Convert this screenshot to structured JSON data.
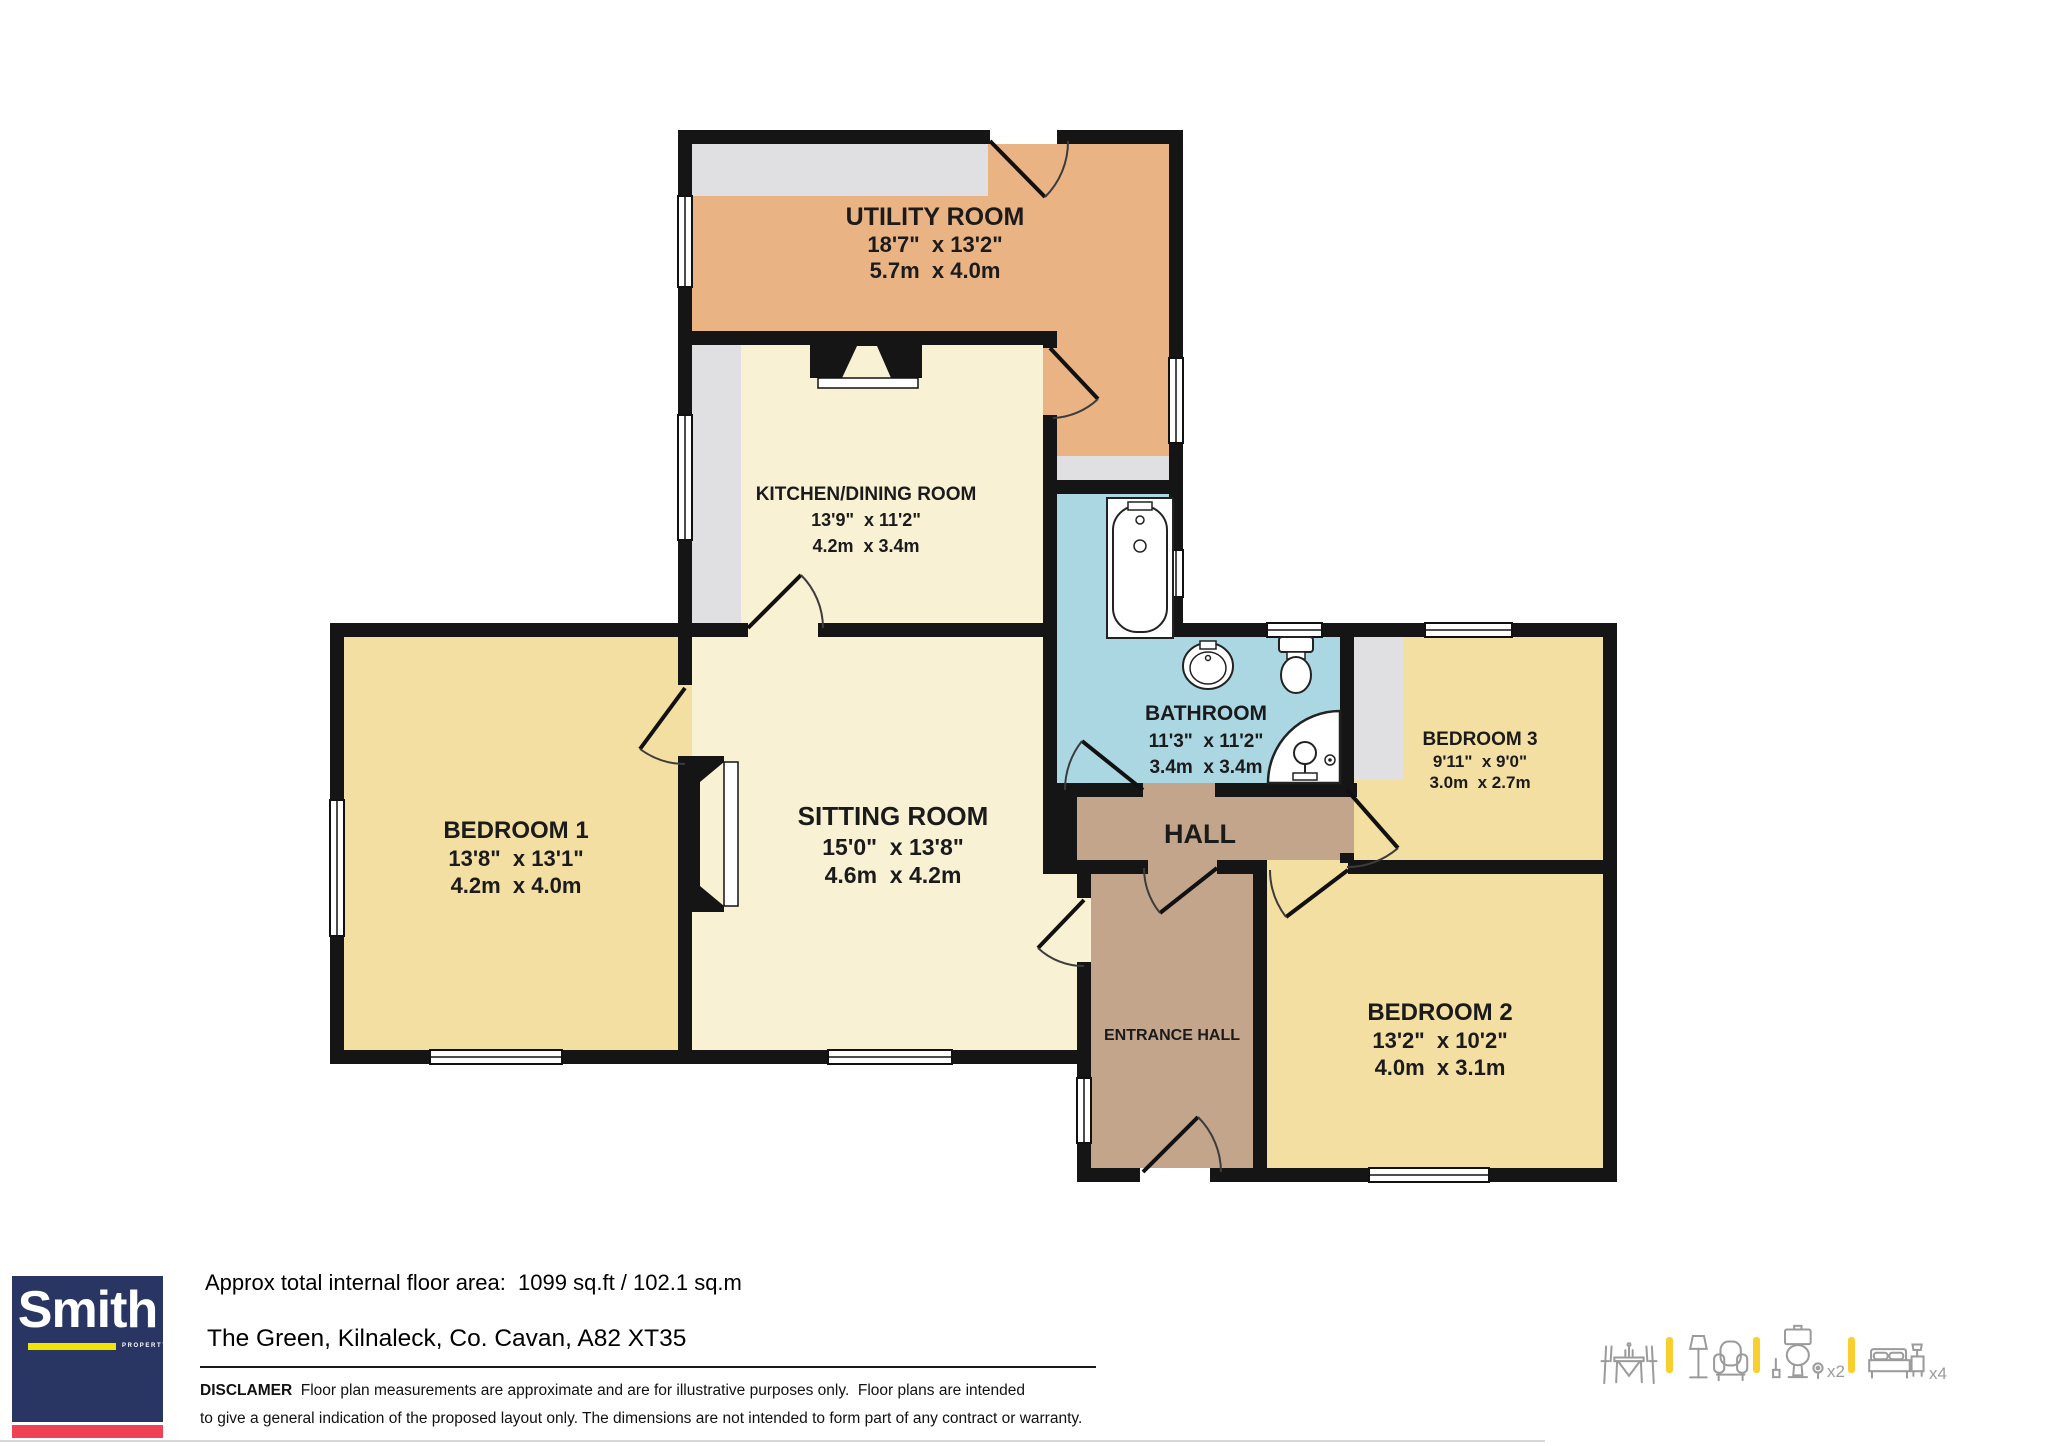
{
  "plan": {
    "rooms": [
      {
        "id": "utility",
        "name": "UTILITY ROOM",
        "imperial": "18'7\"  x 13'2\"",
        "metric": "5.7m  x 4.0m"
      },
      {
        "id": "kitchen",
        "name": "KITCHEN/DINING ROOM",
        "imperial": "13'9\"  x 11'2\"",
        "metric": "4.2m  x 3.4m"
      },
      {
        "id": "bathroom",
        "name": "BATHROOM",
        "imperial": "11'3\"  x 11'2\"",
        "metric": "3.4m  x 3.4m"
      },
      {
        "id": "bedroom1",
        "name": "BEDROOM 1",
        "imperial": "13'8\"  x 13'1\"",
        "metric": "4.2m  x 4.0m"
      },
      {
        "id": "sitting",
        "name": "SITTING ROOM",
        "imperial": "15'0\"  x 13'8\"",
        "metric": "4.6m  x 4.2m"
      },
      {
        "id": "bedroom3",
        "name": "BEDROOM 3",
        "imperial": "9'11\"  x 9'0\"",
        "metric": "3.0m  x 2.7m"
      },
      {
        "id": "hall",
        "name": "HALL"
      },
      {
        "id": "entrance",
        "name": "ENTRANCE HALL"
      },
      {
        "id": "bedroom2",
        "name": "BEDROOM 2",
        "imperial": "13'2\"  x 10'2\"",
        "metric": "4.0m  x 3.1m"
      }
    ],
    "colors": {
      "wall": "#151515",
      "orange": "#e9b384",
      "cream": "#f8f1d4",
      "yellow": "#f3dfa1",
      "blue": "#abd7e3",
      "tan": "#c2a58a",
      "gray": "#e0e0e2"
    }
  },
  "footer": {
    "area_text": "Approx total internal floor area:  1099 sq.ft / 102.1 sq.m",
    "address": "The Green, Kilnaleck, Co. Cavan, A82 XT35",
    "disclaimer_label": "DISCLAMER",
    "disclaimer_line1": "  Floor plan measurements are approximate and are for illustrative purposes only.  Floor plans are intended",
    "disclaimer_line2": "to give a general indication of the proposed layout only. The dimensions are not intended to form part of any contract or warranty.",
    "logo": {
      "name": "Smith",
      "sub": "PROPERTY"
    },
    "icons": [
      {
        "name": "dining-set",
        "count": ""
      },
      {
        "name": "lounge",
        "count": ""
      },
      {
        "name": "toilet",
        "count": "x2"
      },
      {
        "name": "bed",
        "count": "x4"
      }
    ]
  }
}
